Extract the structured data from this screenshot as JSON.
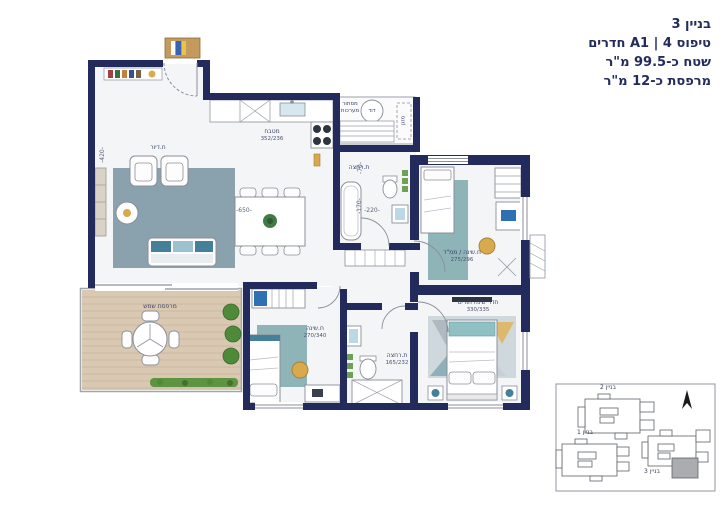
{
  "header": {
    "building": "בניין 3",
    "type_line": "טיפוס A1 | 4 חדרים",
    "area_line": "שטח כ-99.5 מ\"ר",
    "balcony_line": "מרפסת כ-12 מ\"ר"
  },
  "rooms": {
    "living": {
      "name": "ח.דיור"
    },
    "kitchen": {
      "name": "מטבח",
      "dim": "352/236"
    },
    "service": {
      "name": "מסתור מערכות",
      "boiler": "דוד",
      "ac": "מזגן"
    },
    "bath_top": {
      "name": "ת.רחצה"
    },
    "safe_room": {
      "name": "ח.שינה / ממ\"ד",
      "dim": "275/296"
    },
    "master": {
      "name": "חדר שינה הורים",
      "dim": "330/335"
    },
    "bath_bottom": {
      "name": "ת.רחצה",
      "dim": "165/232"
    },
    "bedroom": {
      "name": "ח.שינה",
      "dim": "270/340"
    },
    "balcony": {
      "name": "מרפסת שמש"
    }
  },
  "dims": {
    "d650": "-650-",
    "d420": "-420-",
    "d220": "-220-",
    "d170": "-170-",
    "d70": "-70-"
  },
  "key_plan": {
    "building1": "בניין 1",
    "building2": "בניין 2",
    "building3": "בניין 3"
  },
  "colors": {
    "wall": "#232b5c",
    "text": "#232c5d",
    "rug_teal": "#8fb4b7",
    "rug_blue": "#7b95a4",
    "deck": "#d9c8b2",
    "accent_yellow": "#d9a94d",
    "accent_blue": "#2f6fb3",
    "highlight_gray": "#aaacb0"
  }
}
